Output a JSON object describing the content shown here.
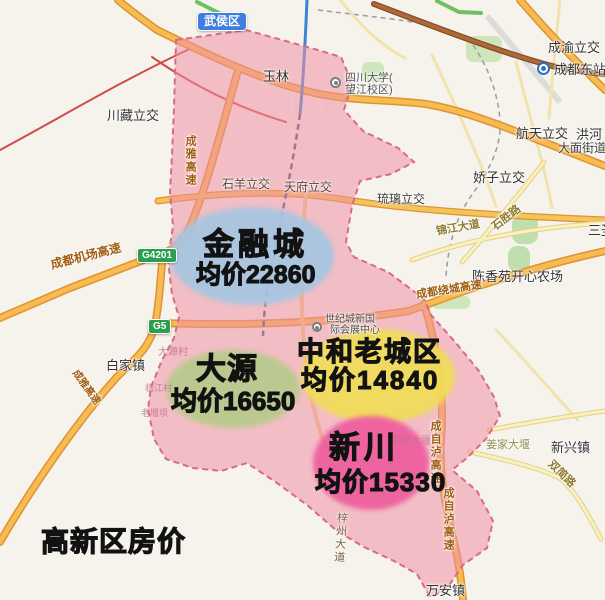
{
  "page_title": "高新区房价",
  "colors": {
    "district_fill": "#ee8fa3",
    "district_border": "#d96a85",
    "expressway_road": "#f8ba52",
    "metro_line": "#3a85d8",
    "district_badge_blue": "#3f7ee0",
    "highway_badge_green": "#2d9e4e"
  },
  "zones": [
    {
      "name": "金融城",
      "price_text": "均价22860",
      "avg_price": 22860,
      "color": "#a6c6e2"
    },
    {
      "name": "大源",
      "price_text": "均价16650",
      "avg_price": 16650,
      "color": "#b7ca8b"
    },
    {
      "name": "中和老城区",
      "price_text": "均价14840",
      "avg_price": 14840,
      "color": "#f0dd58"
    },
    {
      "name": "新川",
      "price_text": "均价15330",
      "avg_price": 15330,
      "color": "#ee609f"
    }
  ],
  "badges": {
    "wuhou_district": "武侯区",
    "g4201": "G4201",
    "g5": "G5"
  },
  "map_labels": {
    "yulin": "玉林",
    "scu_line1": "四川大学(",
    "scu_line2": "望江校区)",
    "chengyu_interchange": "成渝立交",
    "chengdu_east_station": "成都东站",
    "hangtian_interchange": "航天立交",
    "honghe": "洪河",
    "damian_subdistrict": "大面街道",
    "chuanzang_interchange": "川藏立交",
    "shiyang_interchange": "石羊立交",
    "tianfu_interchange": "天府立交",
    "liuli_interchange": "琉璃立交",
    "jiaozi_interchange": "娇子立交",
    "jinjiang_avenue": "锦江大道",
    "shisheng_road": "石胜路",
    "sansheng": "三圣",
    "chenxiangyuan_farm": "陈香苑开心农场",
    "raocheng_expressway": "成都绕城高速",
    "airport_expressway": "成都机场高速",
    "chengya_expressway_north": "成雅高速",
    "chengya_expressway_southwest": "成雅高速",
    "baijia_town": "白家镇",
    "dayuan_village": "大源村",
    "linjiang_village": "临江村",
    "laoyanba": "老堰坝",
    "century_city_expo_line1": "世纪城新国",
    "century_city_expo_line2": "际会展中心",
    "jiangjia_dayan": "姜家大堰",
    "xinxing_town": "新兴镇",
    "shuangjian_road": "双简路",
    "lijia_dayan": "李家大堰",
    "chengzilu_expressway_1": "成自泸高速",
    "chengzilu_expressway_2": "成自泸高速",
    "zizhou_avenue": "梓州大道",
    "wanan_town": "万安镇"
  }
}
